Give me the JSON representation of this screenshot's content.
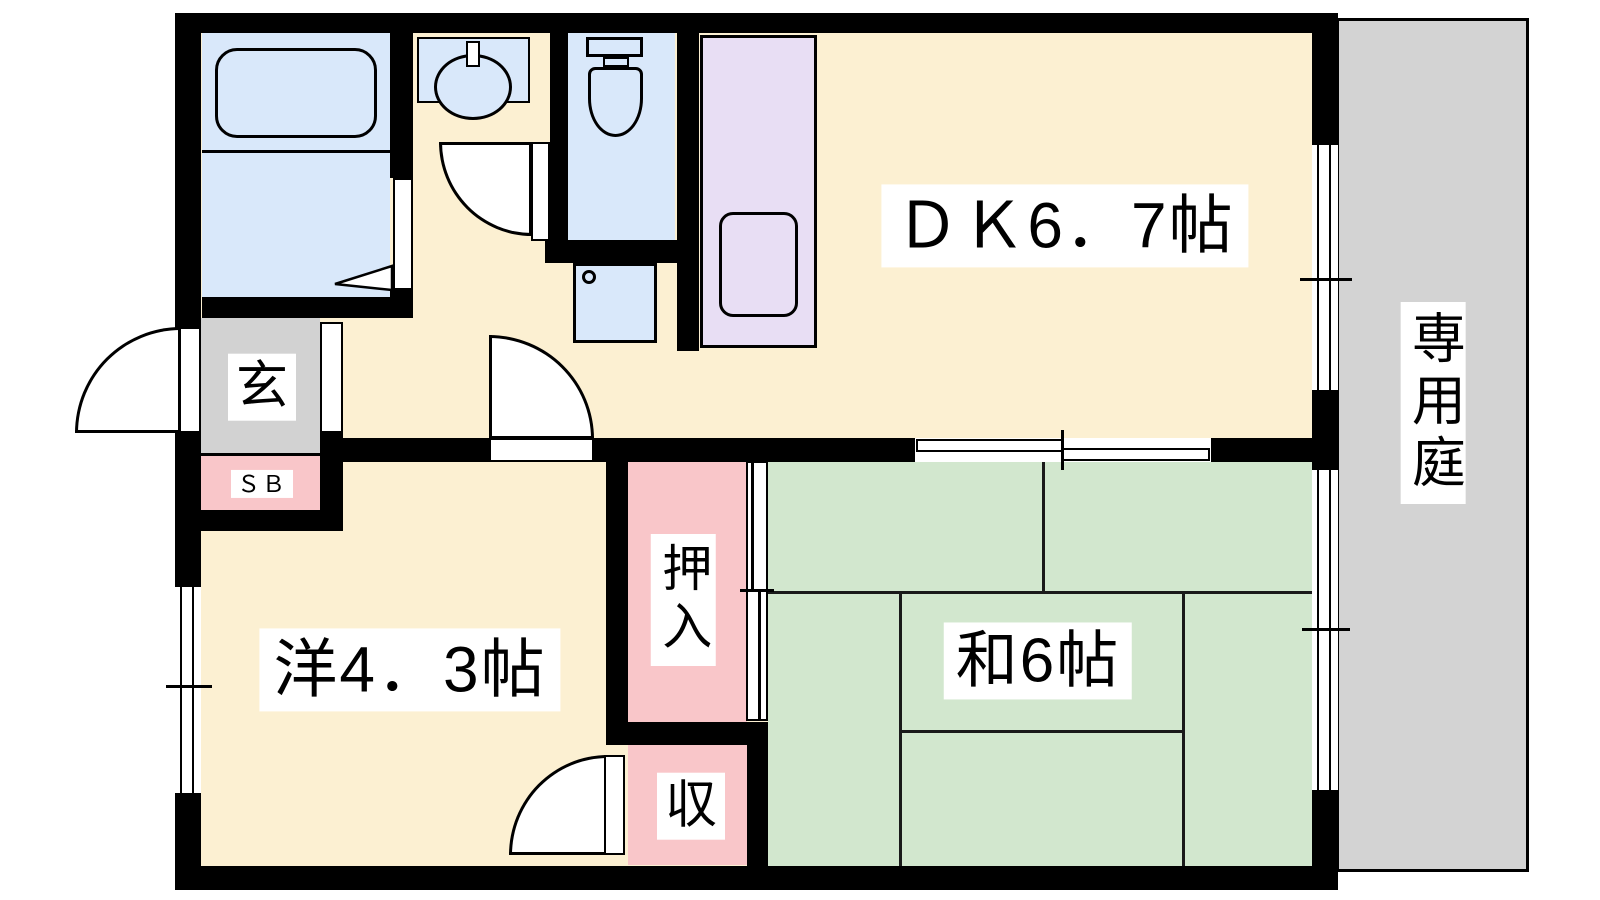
{
  "plan": {
    "rooms": {
      "dk": {
        "label": "ＤＫ6．7帖"
      },
      "western_room": {
        "label": "洋4．3帖"
      },
      "japanese_room": {
        "label": "和6帖"
      },
      "private_garden": {
        "label": "専用庭"
      },
      "entrance": {
        "label": "玄"
      },
      "shoe_box": {
        "label": "ＳＢ"
      },
      "oshiire_closet": {
        "label": "押入"
      },
      "storage": {
        "label": "収"
      }
    },
    "fixtures": {
      "bathtub": "bathtub",
      "washbasin": "washbasin",
      "toilet": "toilet",
      "washing_machine_pan": "washing-machine-pan",
      "kitchen_sink": "kitchen-counter-sink"
    },
    "colors": {
      "wall": "#000000",
      "floor": "#FCF0D2",
      "water_area": "#D9E8FA",
      "tatami": "#D2E7CE",
      "closet": "#F9C6C9",
      "kitchen_counter": "#E8DEF4",
      "entrance_floor": "#D2D2D2",
      "garden": "#D3D3D3",
      "label_background": "#FFFFFF",
      "label_text": "#000000"
    }
  }
}
